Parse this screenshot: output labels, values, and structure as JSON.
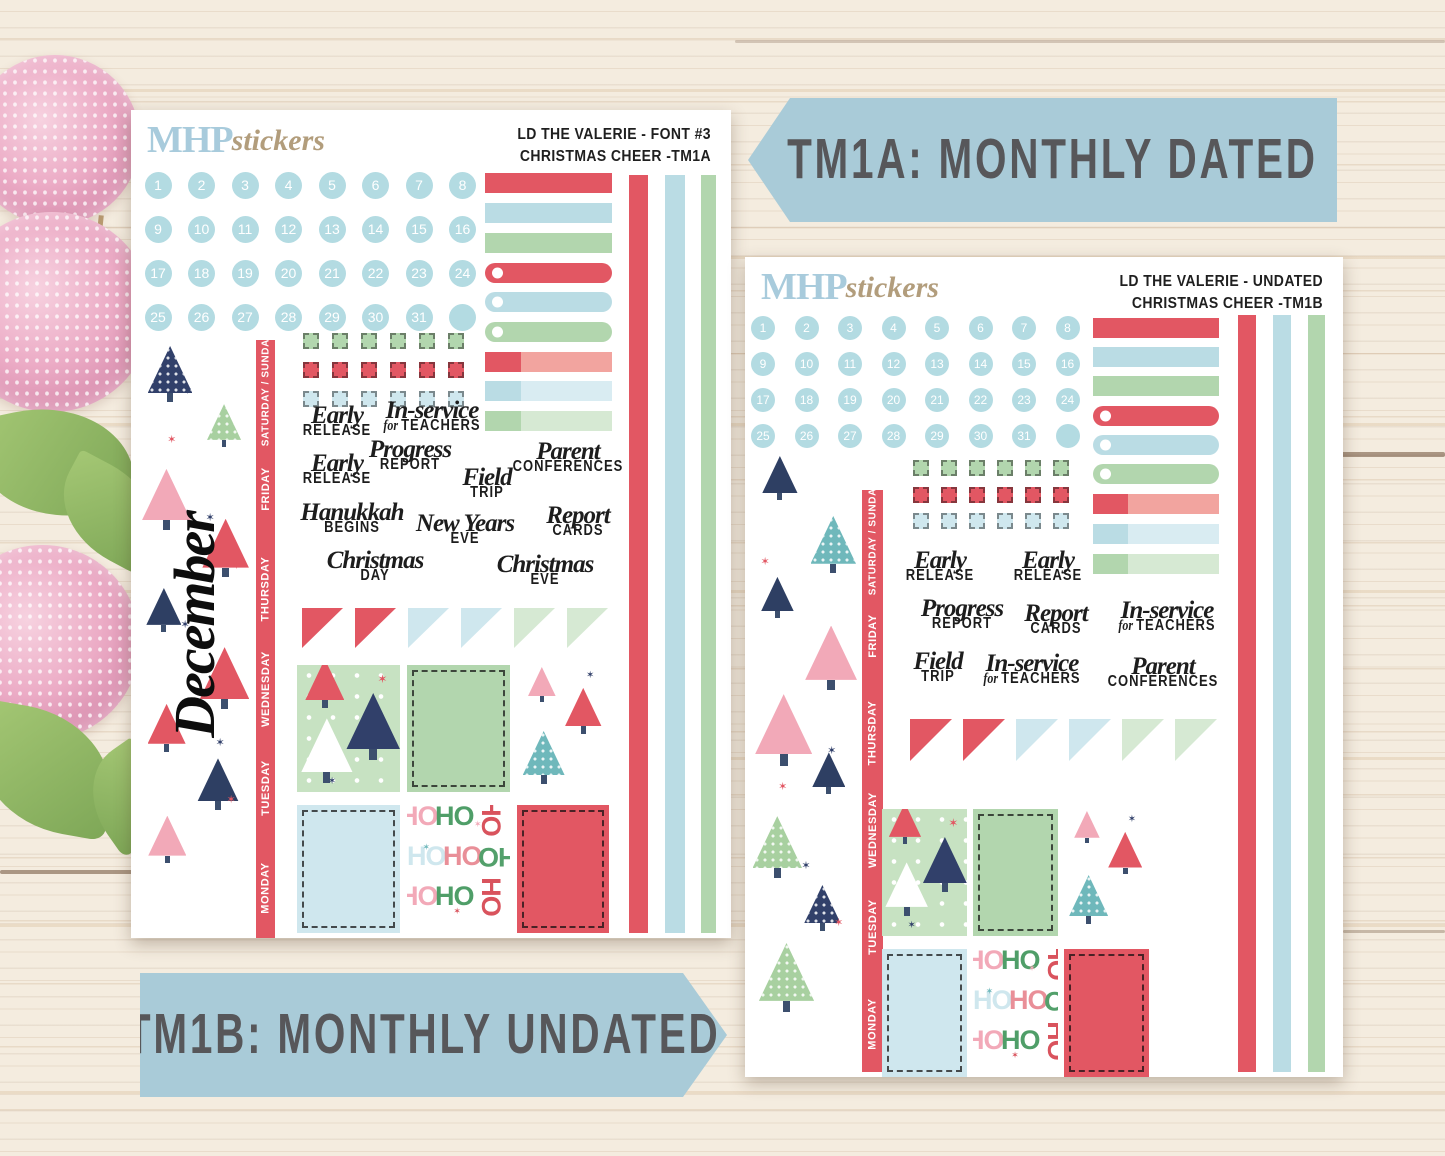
{
  "banners": {
    "top": {
      "label": "TM1A: MONTHLY DATED"
    },
    "bottom": {
      "label": "TM1B: MONTHLY UNDATED"
    }
  },
  "logo": {
    "mhp": "MHP",
    "script": "stickers"
  },
  "sheet_a": {
    "header_line1": "LD THE VALERIE  - FONT #3",
    "header_line2": "CHRISTMAS CHEER -TM1A",
    "month_label": "December",
    "phrase_order": [
      "early_release",
      "in_service",
      "early_release",
      "progress_report",
      "field_trip",
      "parent_conferences",
      "hanukkah_begins",
      "new_years_eve",
      "report_cards",
      "christmas_day",
      "christmas_eve"
    ],
    "boxes": [
      [
        "tree_pattern",
        "green_solid",
        "tree_decor"
      ],
      [
        "blue_solid",
        "hoho",
        "red_solid"
      ]
    ]
  },
  "sheet_b": {
    "header_line1": "LD THE VALERIE - UNDATED",
    "header_line2": "CHRISTMAS CHEER -TM1B",
    "phrase_order": [
      "early_release",
      "early_release",
      "progress_report",
      "report_cards",
      "in_service",
      "field_trip",
      "in_service",
      "parent_conferences"
    ],
    "boxes": [
      [
        "tree_pattern",
        "green_solid",
        "tree_decor"
      ],
      [
        "blue_solid",
        "hoho",
        "red_solid"
      ]
    ]
  },
  "dates": [
    "1",
    "2",
    "3",
    "4",
    "5",
    "6",
    "7",
    "8",
    "9",
    "10",
    "11",
    "12",
    "13",
    "14",
    "15",
    "16",
    "17",
    "18",
    "19",
    "20",
    "21",
    "22",
    "23",
    "24",
    "25",
    "26",
    "27",
    "28",
    "29",
    "30",
    "31",
    ""
  ],
  "weekdays": [
    "SATURDAY / SUNDAY",
    "FRIDAY",
    "THURSDAY",
    "WEDNESDAY",
    "TUESDAY",
    "MONDAY"
  ],
  "phrases": {
    "early_release": {
      "script": "Early",
      "caps": "RELEASE"
    },
    "in_service": {
      "script": "In-service",
      "pre": "for",
      "caps": "TEACHERS"
    },
    "progress_report": {
      "script": "Progress",
      "caps": "REPORT"
    },
    "field_trip": {
      "script": "Field",
      "caps": "TRIP"
    },
    "parent_conferences": {
      "script": "Parent",
      "caps": "CONFERENCES"
    },
    "hanukkah_begins": {
      "script": "Hanukkah",
      "caps": "BEGINS"
    },
    "new_years_eve": {
      "script": "New Years",
      "caps": "EVE"
    },
    "report_cards": {
      "script": "Report",
      "caps": "CARDS"
    },
    "christmas_day": {
      "script": "Christmas",
      "caps": "DAY"
    },
    "christmas_eve": {
      "script": "Christmas",
      "caps": "EVE"
    }
  },
  "bars": [
    {
      "color": "red",
      "style": "plain"
    },
    {
      "color": "blue",
      "style": "plain"
    },
    {
      "color": "green",
      "style": "plain"
    },
    {
      "color": "red",
      "style": "tab"
    },
    {
      "color": "blue",
      "style": "tab"
    },
    {
      "color": "green",
      "style": "tab"
    },
    {
      "color": "red",
      "style": "duo"
    },
    {
      "color": "blue",
      "style": "duo"
    },
    {
      "color": "green",
      "style": "duo"
    }
  ],
  "washi_strips": [
    "red",
    "blue",
    "green"
  ],
  "checkbox_rows": [
    "green",
    "red",
    "blue"
  ],
  "pennant_flags": [
    "red",
    "red",
    "blue",
    "blue",
    "green",
    "green"
  ],
  "hoho": {
    "word": "HO"
  },
  "colors": {
    "red": "#e25763",
    "red_light": "#f2a49f",
    "blue": "#badce4",
    "blue_light": "#d9ecf2",
    "circle_blue": "#b3dbe2",
    "green": "#b2d6ae",
    "green_light": "#d6e9d3",
    "box_blue": "#cfe7ee",
    "navy": "#31406a",
    "pink": "#f2a9b8",
    "teal": "#6fb8bb",
    "tree_bg_green": "#c7e2c2",
    "banner_blue": "#a9cbd8",
    "banner_text": "#57575a",
    "logo_blue": "#a8cbdc",
    "logo_tan": "#b29d7c",
    "ink": "#1d1d1d"
  }
}
